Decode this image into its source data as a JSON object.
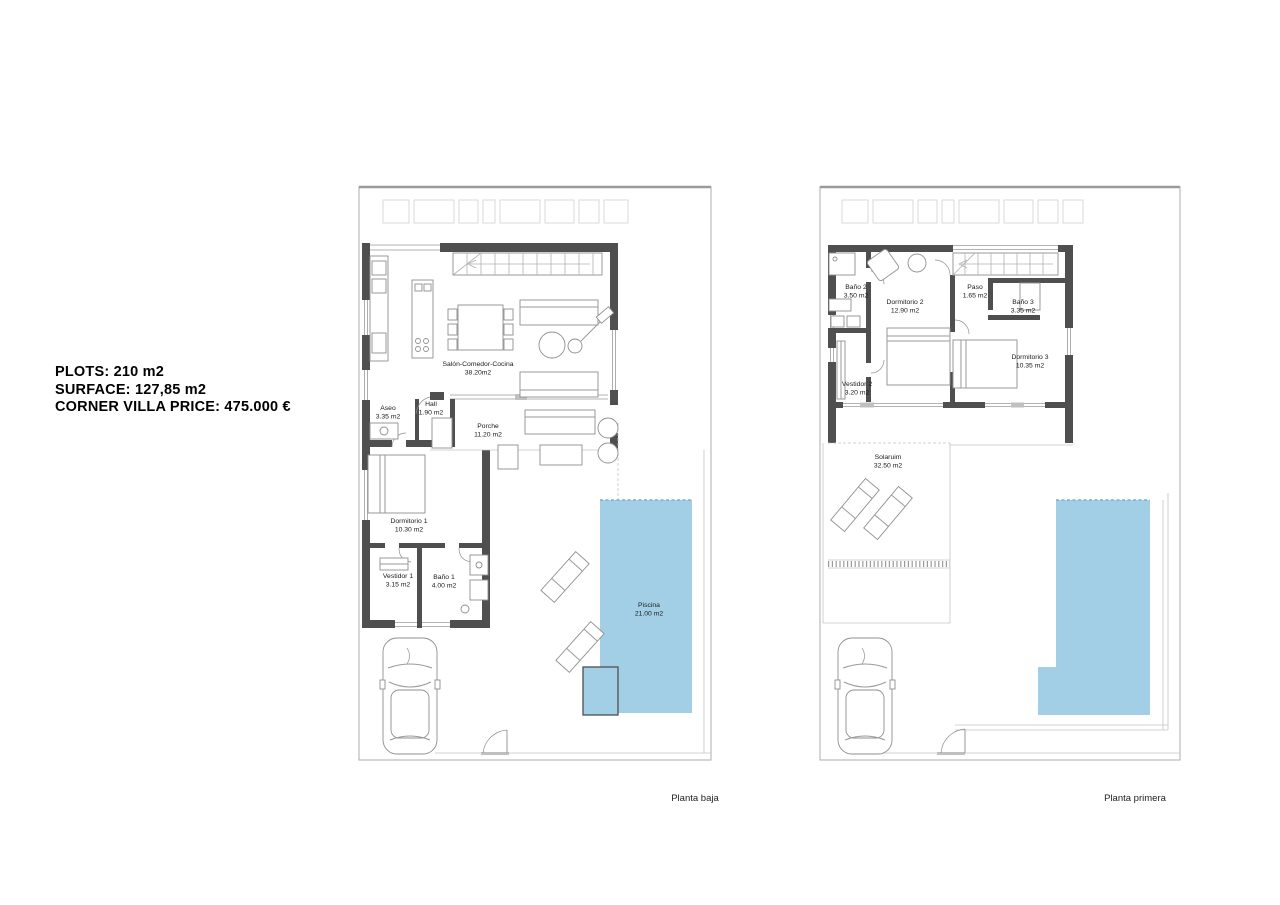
{
  "info_panel": {
    "lines": [
      "PLOTS: 210 m2",
      "SURFACE: 127,85 m2",
      "CORNER VILLA PRICE: 475.000 €"
    ]
  },
  "plans": {
    "ground": {
      "caption": "Planta baja",
      "rooms": [
        {
          "name": "Salón-Comedor-Cocina",
          "area": "38.20m2"
        },
        {
          "name": "Aseo",
          "area": "3.35 m2"
        },
        {
          "name": "Hall",
          "area": "1.90 m2"
        },
        {
          "name": "Porche",
          "area": "11.20 m2"
        },
        {
          "name": "Dormitorio 1",
          "area": "10.30 m2"
        },
        {
          "name": "Vestidor 1",
          "area": "3.15 m2"
        },
        {
          "name": "Baño 1",
          "area": "4.00 m2"
        },
        {
          "name": "Piscina",
          "area": "21.00 m2"
        }
      ]
    },
    "first": {
      "caption": "Planta primera",
      "rooms": [
        {
          "name": "Baño 2",
          "area": "3.50 m2"
        },
        {
          "name": "Dormitorio 2",
          "area": "12.90 m2"
        },
        {
          "name": "Paso",
          "area": "1.65 m2"
        },
        {
          "name": "Baño 3",
          "area": "3.35 m2"
        },
        {
          "name": "Dormitorio 3",
          "area": "10.35 m2"
        },
        {
          "name": "Vestidor 2",
          "area": "3.20 m2"
        },
        {
          "name": "Solaruim",
          "area": "32.50 m2"
        }
      ]
    }
  },
  "colors": {
    "pool": "#a3cfe6",
    "wall": "#4f4f4f",
    "boundary": "#b3b3b3"
  }
}
